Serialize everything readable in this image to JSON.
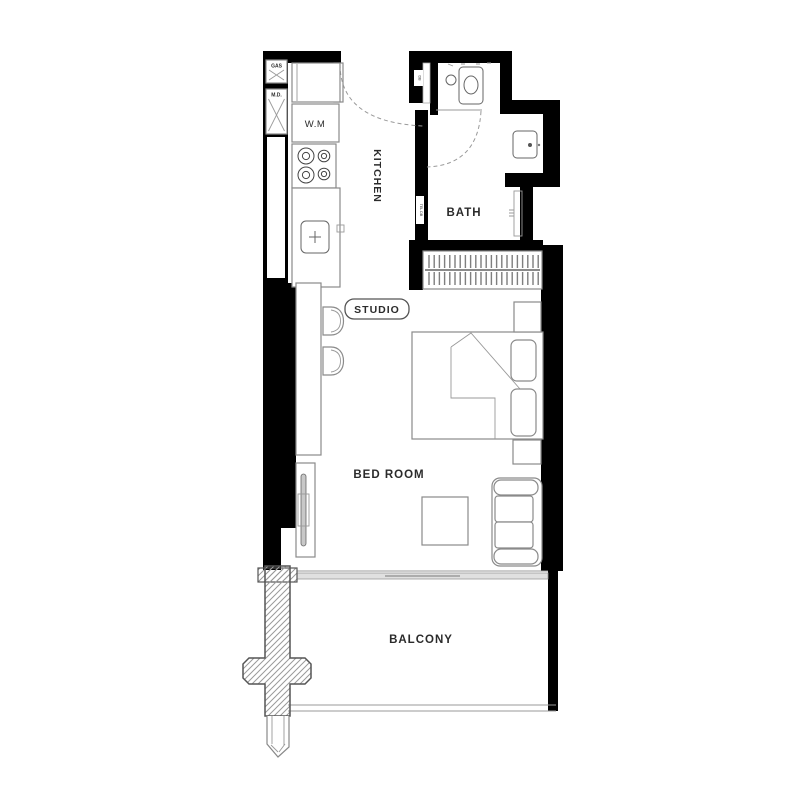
{
  "rooms": {
    "kitchen": "KITCHEN",
    "bath": "BATH",
    "studio": "STUDIO",
    "bedroom": "BED ROOM",
    "balcony": "BALCONY"
  },
  "annotations": {
    "washing_machine": "W.M",
    "gas_meter": "GAS",
    "meter_door": "M.D.",
    "duct_entry": "DB",
    "duct_bath": "TEL DB"
  },
  "colors": {
    "wall": "#000000",
    "furniture_line": "#8a8a8a",
    "fixture_line": "#666666",
    "hatch": "#9a9a9a",
    "text": "#2b2b2b",
    "background": "#ffffff"
  }
}
